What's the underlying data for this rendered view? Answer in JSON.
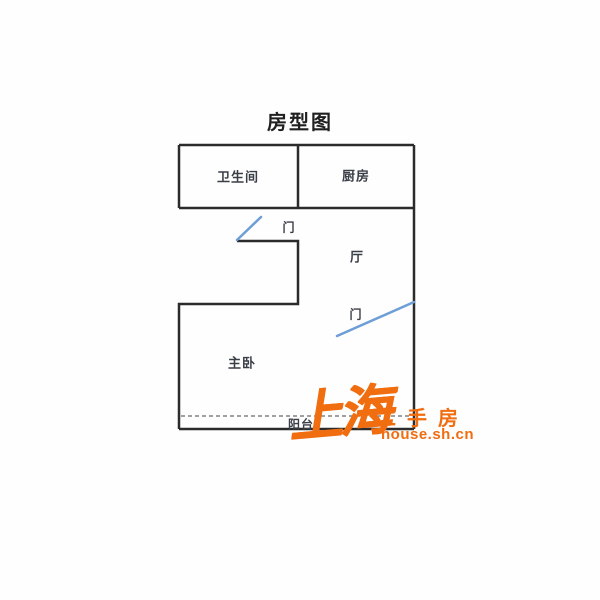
{
  "title": "房型图",
  "floor_plan": {
    "rooms": [
      {
        "name": "bathroom",
        "label": "卫生间"
      },
      {
        "name": "kitchen",
        "label": "厨房"
      },
      {
        "name": "hall",
        "label": "厅"
      },
      {
        "name": "master-bedroom",
        "label": "主卧"
      },
      {
        "name": "balcony",
        "label": "阳台"
      }
    ],
    "doors": [
      {
        "label": "门"
      },
      {
        "label": "门"
      }
    ],
    "colors": {
      "wall": "#2b2b2b",
      "door_swing": "#6e9ed6",
      "room_label": "#3a3e47",
      "balcony_divider": "#808080"
    }
  },
  "watermark": {
    "brand_calligraphy": "上海",
    "brand_text": "二手房",
    "site_url": "house.sh.cn",
    "color": "#f06d10"
  }
}
